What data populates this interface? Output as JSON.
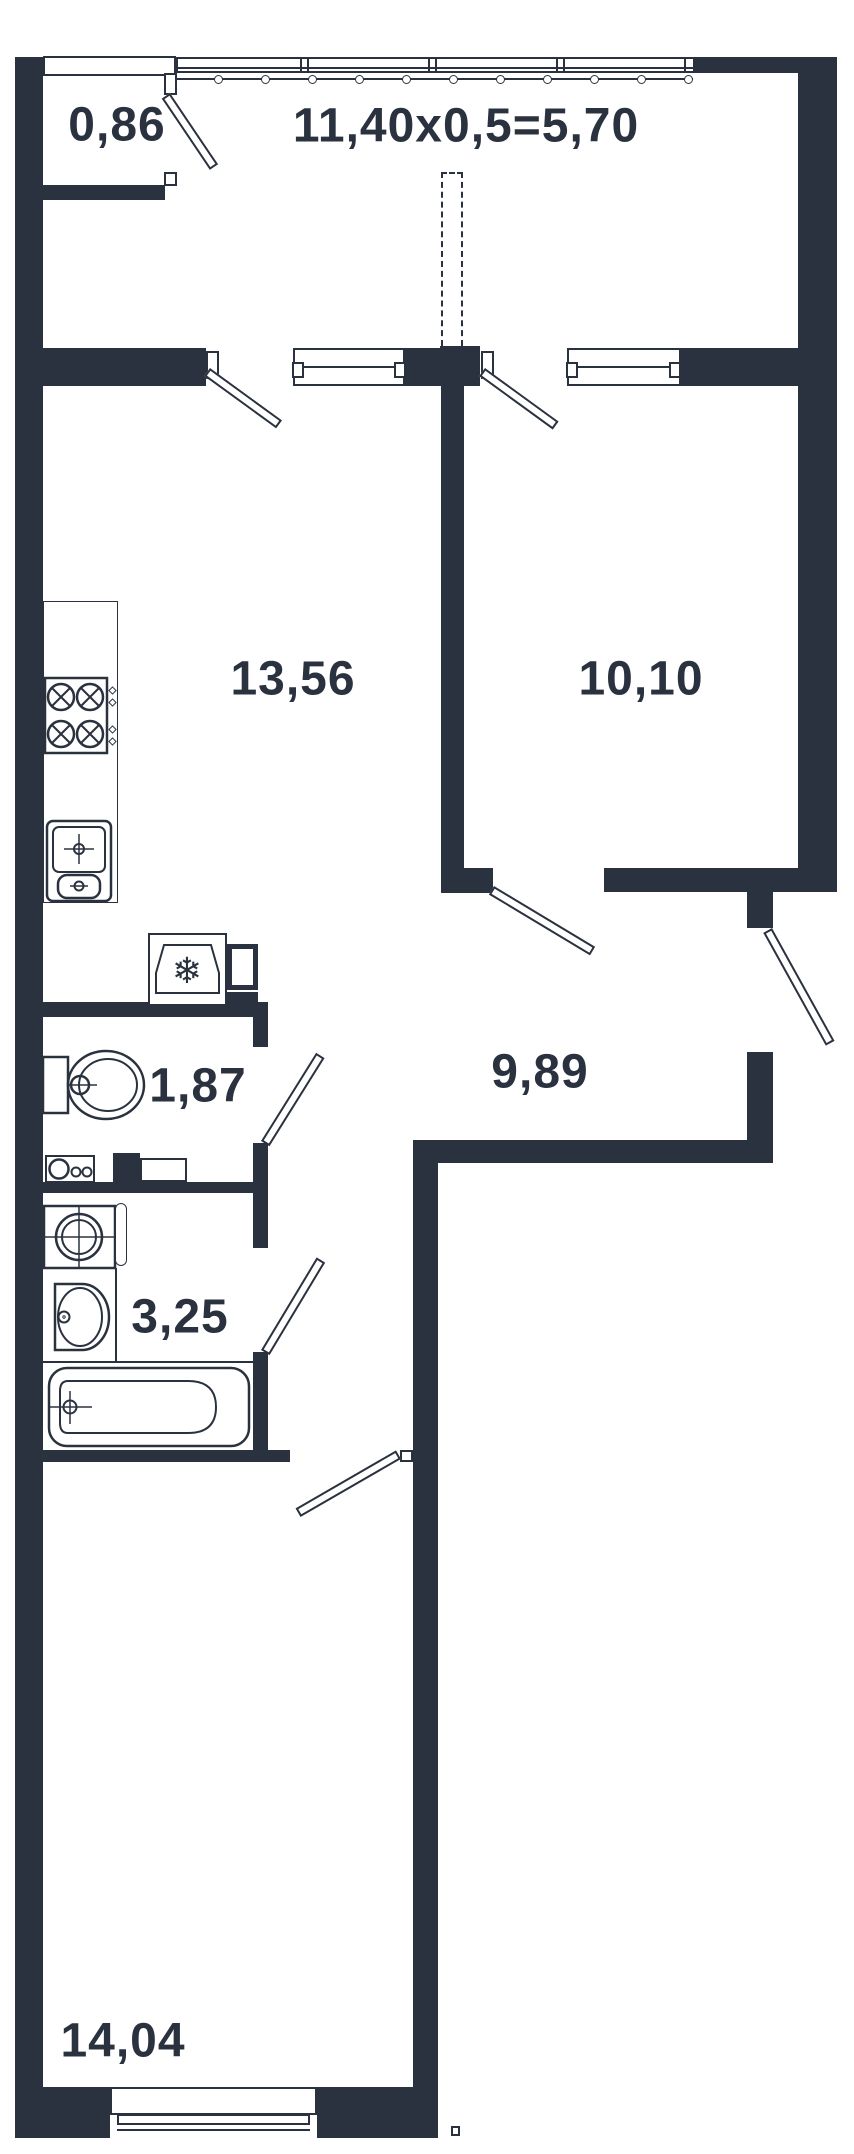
{
  "floor_plan": {
    "title": "apartment-floor-plan",
    "balcony": {
      "area": "0,86",
      "formula": "11,40x0,5=5,70"
    },
    "rooms": {
      "kitchen_living": "13,56",
      "bedroom": "10,10",
      "hallway": "9,89",
      "wc": "1,87",
      "bathroom": "3,25",
      "room": "14,04"
    },
    "colors": {
      "wall": "#2b323f",
      "background": "#ffffff"
    }
  }
}
